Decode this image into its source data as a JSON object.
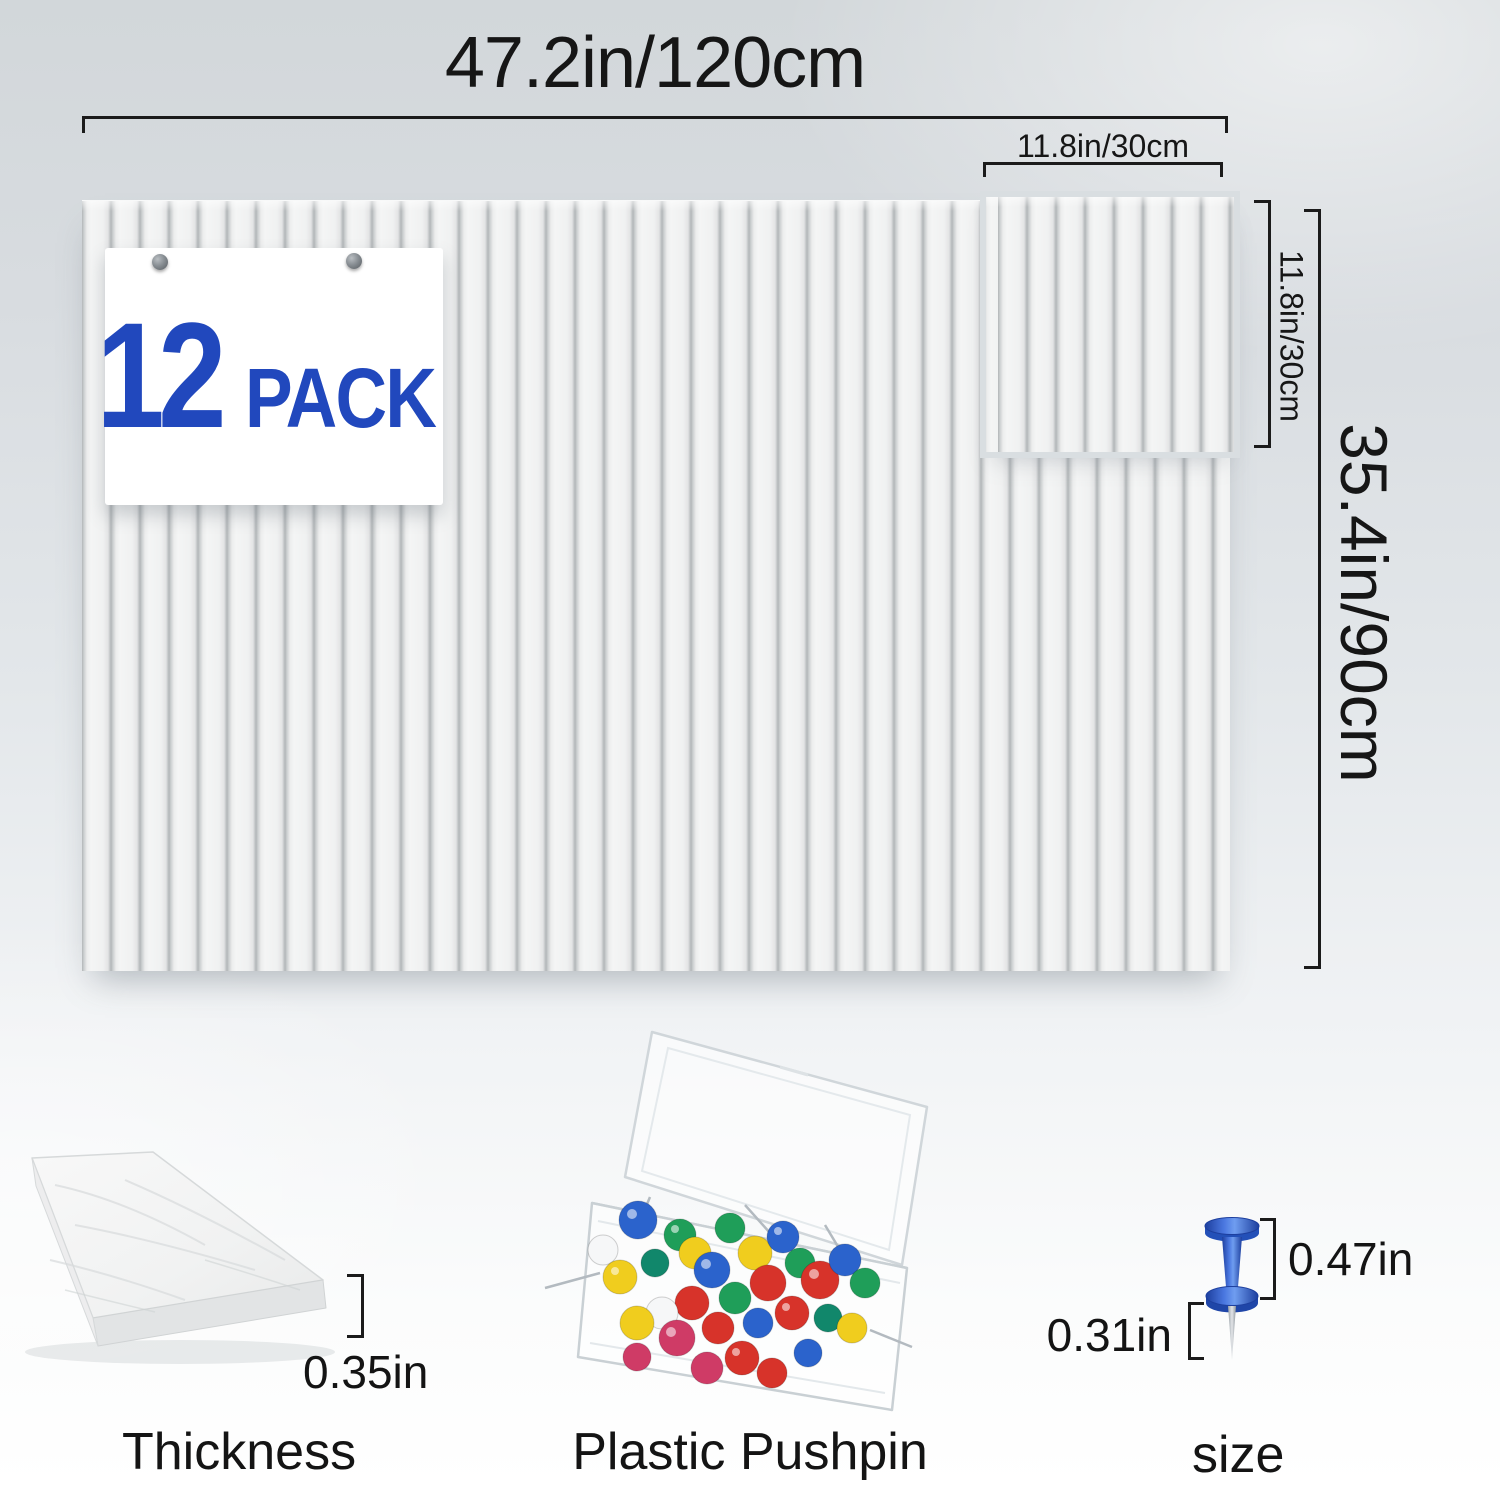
{
  "badge": {
    "count": "12",
    "label": "PACK"
  },
  "dimensions": {
    "total_width": "47.2in/120cm",
    "total_height": "35.4in/90cm",
    "tile_width": "11.8in/30cm",
    "tile_height": "11.8in/30cm",
    "thickness": "0.35in",
    "pin_head_height": "0.47in",
    "pin_needle_length": "0.31in"
  },
  "captions": {
    "thickness": "Thickness",
    "pushpin_box": "Plastic Pushpin",
    "pin_size": "size"
  },
  "colors": {
    "dimension_ink": "#1b1b1b",
    "badge_blue": "#2148bd",
    "pin_blue": "#2e5fd3",
    "pin_blue_dark": "#1d3f9e",
    "pin_blue_light": "#6f9df0",
    "pin_palette": {
      "blue": "#2b63cc",
      "green": "#1f9e59",
      "teal": "#11876b",
      "yellow": "#f0cd1e",
      "red": "#d7332a",
      "white": "#f6f7f8",
      "crimson": "#cf3b66"
    }
  }
}
